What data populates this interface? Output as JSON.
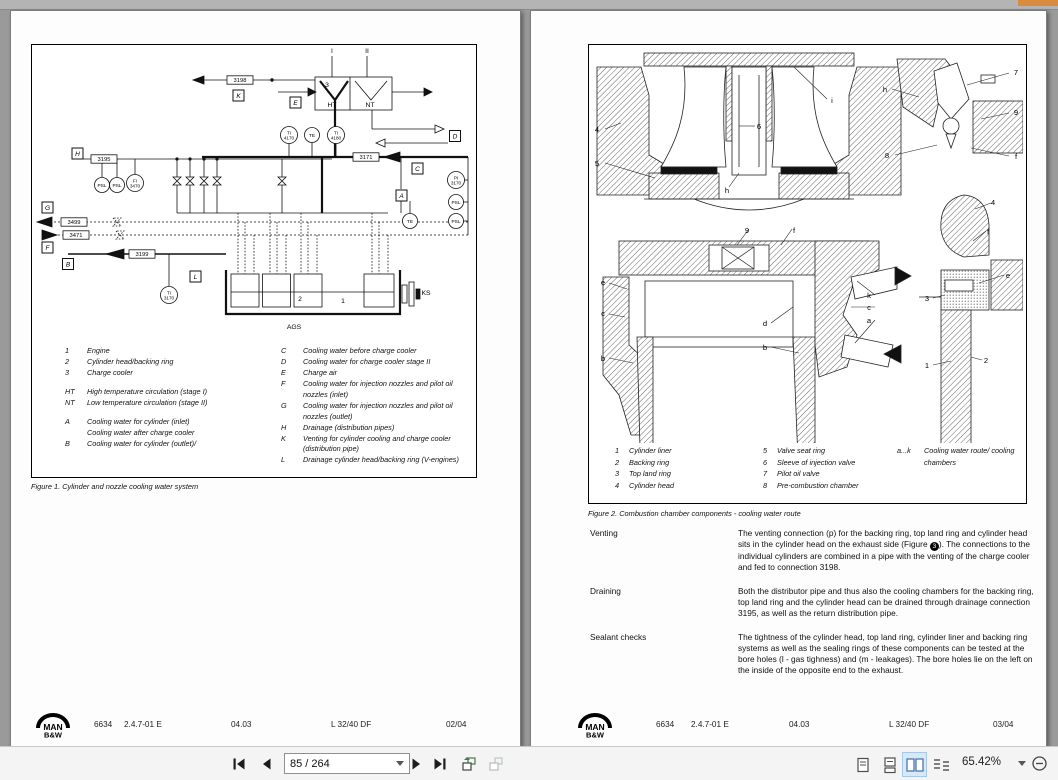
{
  "logo": {
    "line1": "MAN",
    "line2": "B&W"
  },
  "doc": {
    "code": "6634",
    "section": "2.4.7-01 E",
    "date": "04.03",
    "engine": "L 32/40 DF"
  },
  "page_left": {
    "footer": {
      "page": "02/04"
    },
    "figure1": {
      "caption": "Figure 1. Cylinder and nozzle cooling water system",
      "legend_col1": [
        {
          "k": "1",
          "t": "Engine"
        },
        {
          "k": "2",
          "t": "Cylinder head/backing ring"
        },
        {
          "k": "3",
          "t": "Charge cooler"
        },
        {
          "k": "HT",
          "t": "High temperature circulation (stage I)",
          "gap": true
        },
        {
          "k": "NT",
          "t": "Low temperature circulation (stage II)"
        },
        {
          "k": "A",
          "t": "Cooling water for cylinder (inlet)",
          "gap": true
        },
        {
          "k": "",
          "t": "Cooling water after charge cooler"
        },
        {
          "k": "B",
          "t": "Cooling water for cylinder (outlet)/"
        }
      ],
      "legend_col2": [
        {
          "k": "C",
          "t": "Cooling water before charge cooler"
        },
        {
          "k": "D",
          "t": "Cooling water for charge cooler stage II"
        },
        {
          "k": "E",
          "t": "Charge air"
        },
        {
          "k": "F",
          "t": "Cooling water for injection nozzles and pilot oil nozzles (inlet)"
        },
        {
          "k": "G",
          "t": "Cooling water for injection nozzles and pilot oil nozzles (outlet)"
        },
        {
          "k": "H",
          "t": "Drainage (distribution pipes)"
        },
        {
          "k": "K",
          "t": "Venting for cylinder cooling and charge cooler (distribution pipe)"
        },
        {
          "k": "L",
          "t": "Drainage cylinder head/backing ring (V-engines)"
        }
      ],
      "diagram_labels": [
        {
          "kind": "box",
          "x": 206.5,
          "y": 50.5,
          "t": "K"
        },
        {
          "kind": "box",
          "x": 263.5,
          "y": 57.5,
          "t": "E"
        },
        {
          "kind": "box",
          "x": 45.5,
          "y": 108.5,
          "t": "H"
        },
        {
          "kind": "box",
          "x": 15.5,
          "y": 162.5,
          "t": "G"
        },
        {
          "kind": "box",
          "x": 15.5,
          "y": 202.5,
          "t": "F"
        },
        {
          "kind": "box",
          "x": 36,
          "y": 219,
          "t": "B"
        },
        {
          "kind": "box",
          "x": 163.5,
          "y": 231.5,
          "t": "L"
        },
        {
          "kind": "box",
          "x": 369.5,
          "y": 150.5,
          "t": "A"
        },
        {
          "kind": "box",
          "x": 385.5,
          "y": 123.5,
          "t": "C"
        },
        {
          "kind": "box",
          "x": 423,
          "y": 91,
          "t": "D"
        },
        {
          "kind": "pipe",
          "x": 208,
          "y": 35,
          "t": "3198"
        },
        {
          "kind": "pipe",
          "x": 72,
          "y": 114,
          "t": "3195"
        },
        {
          "kind": "pipe",
          "x": 334,
          "y": 112,
          "t": "3171"
        },
        {
          "kind": "pipe",
          "x": 42,
          "y": 177,
          "t": "3499"
        },
        {
          "kind": "pipe",
          "x": 44,
          "y": 190,
          "t": "3471"
        },
        {
          "kind": "pipe",
          "x": 110,
          "y": 209,
          "t": "3199"
        },
        {
          "kind": "circ",
          "x": 257,
          "y": 90,
          "r": 8.5,
          "l1": "TI",
          "l2": "4170"
        },
        {
          "kind": "circ",
          "x": 280,
          "y": 90,
          "r": 7.5,
          "l1": "TE"
        },
        {
          "kind": "circ",
          "x": 304,
          "y": 90,
          "r": 8.5,
          "l1": "TI",
          "l2": "4180"
        },
        {
          "kind": "circ",
          "x": 424,
          "y": 135,
          "r": 8.5,
          "l1": "PI",
          "l2": "3170"
        },
        {
          "kind": "circ",
          "x": 424,
          "y": 157,
          "r": 7.5,
          "l1": "PSL"
        },
        {
          "kind": "circ",
          "x": 424,
          "y": 176,
          "r": 7.5,
          "l1": "PSL"
        },
        {
          "kind": "circ",
          "x": 70,
          "y": 140,
          "r": 7.5,
          "l1": "PSL"
        },
        {
          "kind": "circ",
          "x": 85,
          "y": 140,
          "r": 7.5,
          "l1": "PSL"
        },
        {
          "kind": "circ",
          "x": 103,
          "y": 138,
          "r": 8.5,
          "l1": "FI",
          "l2": "3470"
        },
        {
          "kind": "circ",
          "x": 378,
          "y": 176,
          "r": 7.5,
          "l1": "TE"
        },
        {
          "kind": "circ",
          "x": 137,
          "y": 250,
          "r": 8.5,
          "l1": "TI",
          "l2": "3170"
        },
        {
          "kind": "text",
          "x": 300,
          "y": 8,
          "t": "I"
        },
        {
          "kind": "text",
          "x": 335,
          "y": 8,
          "t": "II"
        },
        {
          "kind": "text",
          "x": 295,
          "y": 42,
          "t": "3"
        },
        {
          "kind": "text",
          "x": 300,
          "y": 62,
          "t": "HT"
        },
        {
          "kind": "text",
          "x": 338,
          "y": 62,
          "t": "NT"
        },
        {
          "kind": "text",
          "x": 268,
          "y": 256,
          "t": "2"
        },
        {
          "kind": "text",
          "x": 311,
          "y": 258,
          "t": "1"
        },
        {
          "kind": "text",
          "x": 394,
          "y": 250,
          "t": "KS"
        },
        {
          "kind": "text",
          "x": 262,
          "y": 284,
          "t": "AGS"
        }
      ]
    }
  },
  "page_right": {
    "footer": {
      "page": "03/04"
    },
    "figure2": {
      "caption": "Figure 2. Combustion chamber components - cooling water route",
      "legend_col1": [
        {
          "k": "1",
          "t": "Cylinder liner"
        },
        {
          "k": "2",
          "t": "Backing ring"
        },
        {
          "k": "3",
          "t": "Top land ring"
        },
        {
          "k": "4",
          "t": "Cylinder head"
        }
      ],
      "legend_col2": [
        {
          "k": "5",
          "t": "Valve seat ring"
        },
        {
          "k": "6",
          "t": "Sleeve of injection valve"
        },
        {
          "k": "7",
          "t": "Pilot oil valve"
        },
        {
          "k": "8",
          "t": "Pre-combustion chamber"
        }
      ],
      "legend_col3": [
        {
          "k": "a...k",
          "t": "Cooling water route/ cooling chambers"
        }
      ],
      "diagram_labels": [
        {
          "x": 8,
          "y": 87,
          "t": "4"
        },
        {
          "x": 8,
          "y": 121,
          "t": "5"
        },
        {
          "x": 170,
          "y": 84,
          "t": "6"
        },
        {
          "x": 138,
          "y": 148,
          "t": "h"
        },
        {
          "x": 243,
          "y": 58,
          "t": "i"
        },
        {
          "x": 296,
          "y": 47,
          "t": "h"
        },
        {
          "x": 427,
          "y": 30,
          "t": "7"
        },
        {
          "x": 427,
          "y": 70,
          "t": "9"
        },
        {
          "x": 298,
          "y": 113,
          "t": "8"
        },
        {
          "x": 427,
          "y": 114,
          "t": "f"
        },
        {
          "x": 158,
          "y": 188,
          "t": "9"
        },
        {
          "x": 205,
          "y": 188,
          "t": "f"
        },
        {
          "x": 14,
          "y": 240,
          "t": "e"
        },
        {
          "x": 14,
          "y": 271,
          "t": "c"
        },
        {
          "x": 14,
          "y": 316,
          "t": "b"
        },
        {
          "x": 176,
          "y": 281,
          "t": "d"
        },
        {
          "x": 176,
          "y": 305,
          "t": "b"
        },
        {
          "x": 280,
          "y": 253,
          "t": "k"
        },
        {
          "x": 280,
          "y": 265,
          "t": "c"
        },
        {
          "x": 280,
          "y": 278,
          "t": "a"
        },
        {
          "x": 404,
          "y": 160,
          "t": "4"
        },
        {
          "x": 399,
          "y": 189,
          "t": "f"
        },
        {
          "x": 419,
          "y": 233,
          "t": "e"
        },
        {
          "x": 338,
          "y": 256,
          "t": "3"
        },
        {
          "x": 338,
          "y": 323,
          "t": "1"
        },
        {
          "x": 397,
          "y": 318,
          "t": "2"
        }
      ]
    },
    "sections": [
      {
        "label": "Venting",
        "pre": "The venting connection (p) for the backing ring, top land ring and cylinder head sits in the cylinder head on the exhaust side (Figure ",
        "fig": "3",
        "post": "). The connections to the individual cylinders are combined in a pipe with the venting of the charge cooler and fed to connection 3198."
      },
      {
        "label": "Draining",
        "pre": "Both the distributor pipe and thus also the cooling chambers for the backing ring, top land ring and the cylinder head can be drained through drainage connection 3195, as well as the return distribution pipe."
      },
      {
        "label": "Sealant checks",
        "pre": "The tightness of the cylinder head, top land ring, cylinder liner and backing ring systems as well as the sealing rings of these components can be tested at the bore holes (l - gas tighness) and (m - leakages). The bore holes lie on the left on the inside of the opposite end to the exhaust."
      }
    ]
  },
  "toolbar": {
    "page_field": "85 / 264",
    "zoom_level": "65.42%",
    "buttons": [
      "first-page",
      "previous-page",
      "next-page",
      "last-page",
      "previous-view",
      "next-view"
    ],
    "view_modes": [
      "single-page",
      "single-page-continuous",
      "two-page",
      "two-page-continuous"
    ],
    "selected_view_mode": "two-page"
  }
}
